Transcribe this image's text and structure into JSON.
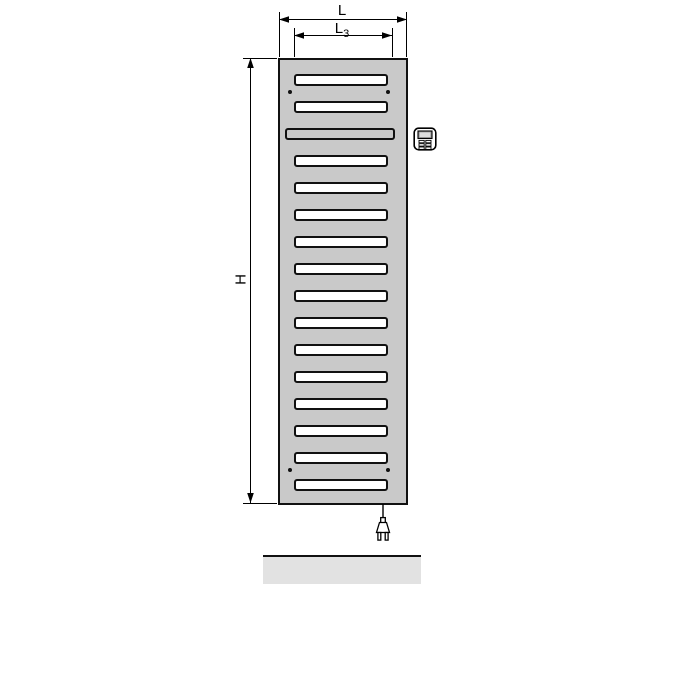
{
  "diagram": {
    "labels": {
      "overall_width": "L",
      "slat_width_base": "L",
      "slat_width_sub": "3",
      "overall_height": "H"
    },
    "radiator": {
      "slat_count": 16,
      "special_slat_position": 3,
      "mounting_dot_pairs": 2,
      "body_color": "#c9c9c9",
      "slat_color": "#ffffff",
      "outline_color": "#111111"
    },
    "floor": {
      "color": "#e2e2e2"
    },
    "icons": {
      "control_unit": "control-unit-icon",
      "power_plug": "power-plug-icon"
    }
  }
}
